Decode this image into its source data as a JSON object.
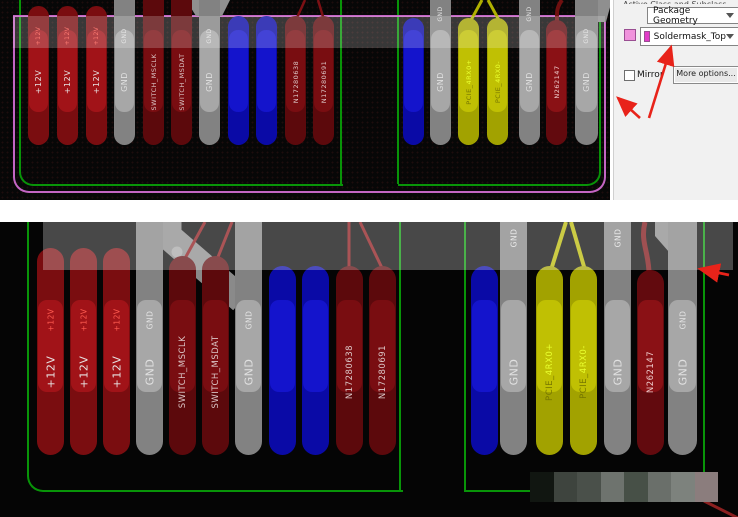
{
  "panel": {
    "header_clipped": "Active Class and Subclass",
    "class_dropdown_value": "Package Geometry",
    "subclass_dropdown_value": "Soldermask_Top",
    "mirror_label": "Mirror",
    "more_options_label": "More options...",
    "swatch_color": "#f093dc",
    "subclass_swatch_color": "#e23cc8",
    "annotation_arrow_color": "#e8231a"
  },
  "board": {
    "outline_color": "#089408",
    "soldermask_outline_color": "#c465c4",
    "highlight_band_color": "rgba(255,255,255,0.24)"
  },
  "pad_types": {
    "red": {
      "outer": "#7a0d10",
      "inner": "#a31419",
      "small": "#ff5a50",
      "text": "#e6e0e0"
    },
    "maroon": {
      "outer": "#5c090c",
      "inner": "#7a0e12",
      "small": "#e0b6b6",
      "text": "#dcc6c6"
    },
    "darkred": {
      "outer": "#620a0e",
      "inner": "#8c1216",
      "small": "#e8c8c8",
      "text": "#ecc9c9"
    },
    "gray": {
      "outer": "#828282",
      "inner": "#a9a9a9",
      "small": "#e3e3e3",
      "text": "#e0e0e0"
    },
    "blue": {
      "outer": "#0a0aa6",
      "inner": "#1515cd",
      "small": "#cccccc",
      "text": "#dddddd"
    },
    "yellow": {
      "outer": "#a2a200",
      "inner": "#c2c203",
      "small": "#6e6e00",
      "text": "#767600",
      "suffix": "#e9ff2e"
    }
  },
  "views": {
    "top": {
      "cfg": {
        "pad_w": 21,
        "pad_bottom": 145,
        "band_top": 30,
        "band_h": 82,
        "big_y": 82,
        "small_y": 36,
        "small_top_y": 14,
        "font_big": 8,
        "font_small": 6,
        "font_long": 6.5
      },
      "pads": [
        {
          "net": "+12V",
          "type": "red",
          "x": 28,
          "top": 6,
          "small": "+12V"
        },
        {
          "net": "+12V",
          "type": "red",
          "x": 57,
          "top": 6,
          "small": "+12V"
        },
        {
          "net": "+12V",
          "type": "red",
          "x": 86,
          "top": 6,
          "small": "+12V"
        },
        {
          "net": "GND",
          "type": "gray",
          "x": 114,
          "top": 0,
          "small": "GND"
        },
        {
          "net": "SWITCH_MSCLK",
          "type": "maroon",
          "x": 143,
          "top": 0
        },
        {
          "net": "SWITCH_MSDAT",
          "type": "maroon",
          "x": 171,
          "top": 0
        },
        {
          "net": "GND",
          "type": "gray",
          "x": 199,
          "top": 0,
          "small": "GND"
        },
        {
          "net": "",
          "type": "blue",
          "x": 228,
          "top": 16
        },
        {
          "net": "",
          "type": "blue",
          "x": 256,
          "top": 16
        },
        {
          "net": "N17280638",
          "type": "maroon",
          "x": 285,
          "top": 16
        },
        {
          "net": "N17280691",
          "type": "maroon",
          "x": 313,
          "top": 16
        },
        {
          "net": "",
          "type": "blue",
          "x": 403,
          "top": 18
        },
        {
          "net": "GND",
          "type": "gray",
          "x": 430,
          "top": 0,
          "small": "GND",
          "small_top": true
        },
        {
          "net": "PCIE_4RX0+",
          "type": "yellow",
          "x": 458,
          "top": 18,
          "base": "PCIE_",
          "suffix": "4RX0+"
        },
        {
          "net": "PCIE_4RX0-",
          "type": "yellow",
          "x": 487,
          "top": 18,
          "base": "PCIE_",
          "suffix": "4RX0-"
        },
        {
          "net": "GND",
          "type": "gray",
          "x": 519,
          "top": 0,
          "small": "GND",
          "small_top": true
        },
        {
          "net": "N262147",
          "type": "darkred",
          "x": 546,
          "top": 20
        },
        {
          "net": "GND",
          "type": "gray",
          "x": 575,
          "w": 23,
          "top": 0,
          "small": "GND"
        }
      ]
    },
    "bottom": {
      "cfg": {
        "pad_w": 27,
        "pad_bottom": 233,
        "band_top": 78,
        "band_h": 92,
        "big_y": 150,
        "small_y": 98,
        "small_top_y": 16,
        "font_big": 11,
        "font_small": 7.5,
        "font_long": 8.5
      },
      "pads": [
        {
          "net": "+12V",
          "type": "red",
          "x": 37,
          "top": 26,
          "small": "+12V"
        },
        {
          "net": "+12V",
          "type": "red",
          "x": 70,
          "top": 26,
          "small": "+12V"
        },
        {
          "net": "+12V",
          "type": "red",
          "x": 103,
          "top": 26,
          "small": "+12V"
        },
        {
          "net": "GND",
          "type": "gray",
          "x": 136,
          "top": 0,
          "small": "GND"
        },
        {
          "net": "SWITCH_MSCLK",
          "type": "maroon",
          "x": 169,
          "top": 34
        },
        {
          "net": "SWITCH_MSDAT",
          "type": "maroon",
          "x": 202,
          "top": 34
        },
        {
          "net": "GND",
          "type": "gray",
          "x": 235,
          "top": 0,
          "small": "GND"
        },
        {
          "net": "",
          "type": "blue",
          "x": 269,
          "top": 44
        },
        {
          "net": "",
          "type": "blue",
          "x": 302,
          "top": 44
        },
        {
          "net": "N17280638",
          "type": "maroon",
          "x": 336,
          "top": 44
        },
        {
          "net": "N17280691",
          "type": "maroon",
          "x": 369,
          "top": 44
        },
        {
          "net": "",
          "type": "blue",
          "x": 471,
          "top": 44
        },
        {
          "net": "GND",
          "type": "gray",
          "x": 500,
          "top": 0,
          "small": "GND",
          "small_top": true
        },
        {
          "net": "PCIE_4RX0+",
          "type": "yellow",
          "x": 536,
          "top": 44,
          "base": "PCIE_",
          "suffix": "4RX0+"
        },
        {
          "net": "PCIE_4RX0-",
          "type": "yellow",
          "x": 570,
          "top": 44,
          "base": "PCIE_",
          "suffix": "4RX0-"
        },
        {
          "net": "GND",
          "type": "gray",
          "x": 604,
          "top": 0,
          "small": "GND",
          "small_top": true
        },
        {
          "net": "N262147",
          "type": "darkred",
          "x": 637,
          "top": 48
        },
        {
          "net": "GND",
          "type": "gray",
          "x": 668,
          "w": 29,
          "top": 0,
          "small": "GND"
        }
      ]
    }
  },
  "mosaic": {
    "tiles": [
      "#111611",
      "#3e443e",
      "#4a504a",
      "#6e736e",
      "#475047",
      "#6a6f6a",
      "#7d827d",
      "#8b7d7d"
    ],
    "light_bottom": [
      0,
      1,
      4,
      7
    ]
  }
}
